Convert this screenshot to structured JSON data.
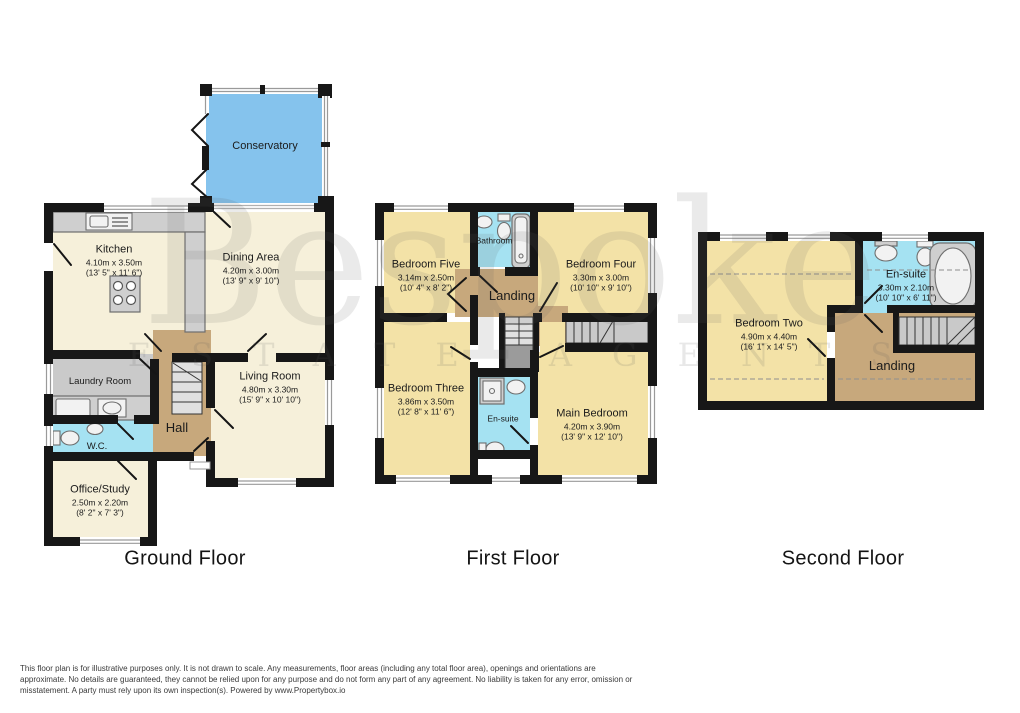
{
  "colors": {
    "wall": "#171717",
    "cream": "#f6f0da",
    "yellow": "#f3e2a7",
    "conservatory_blue": "#85c3ed",
    "bath_blue": "#a5e2f2",
    "hall_tan": "#c7a87c",
    "laundry_gray": "#cacaca"
  },
  "watermark": {
    "name": "Bespoke",
    "tagline": "ESTATE AGENTS"
  },
  "floors": {
    "ground": {
      "title": "Ground Floor",
      "rooms": {
        "conservatory": {
          "name": "Conservatory"
        },
        "kitchen": {
          "name": "Kitchen",
          "metric": "4.10m x 3.50m",
          "imperial": "(13' 5\" x 11' 6\")"
        },
        "dining": {
          "name": "Dining Area",
          "metric": "4.20m x 3.00m",
          "imperial": "(13' 9\" x 9' 10\")"
        },
        "laundry": {
          "name": "Laundry Room"
        },
        "hall": {
          "name": "Hall"
        },
        "wc": {
          "name": "W.C."
        },
        "living": {
          "name": "Living Room",
          "metric": "4.80m x 3.30m",
          "imperial": "(15' 9\" x 10' 10\")"
        },
        "office": {
          "name": "Office/Study",
          "metric": "2.50m x 2.20m",
          "imperial": "(8' 2\" x 7' 3\")"
        }
      }
    },
    "first": {
      "title": "First Floor",
      "rooms": {
        "bedroom5": {
          "name": "Bedroom Five",
          "metric": "3.14m x 2.50m",
          "imperial": "(10' 4\" x 8' 2\")"
        },
        "bathroom": {
          "name": "Bathroom"
        },
        "bedroom4": {
          "name": "Bedroom Four",
          "metric": "3.30m x 3.00m",
          "imperial": "(10' 10\" x 9' 10\")"
        },
        "landing": {
          "name": "Landing"
        },
        "bedroom3": {
          "name": "Bedroom Three",
          "metric": "3.86m x 3.50m",
          "imperial": "(12' 8\" x 11' 6\")"
        },
        "ensuite": {
          "name": "En-suite"
        },
        "main": {
          "name": "Main Bedroom",
          "metric": "4.20m x 3.90m",
          "imperial": "(13' 9\" x 12' 10\")"
        }
      }
    },
    "second": {
      "title": "Second Floor",
      "rooms": {
        "bedroom2": {
          "name": "Bedroom Two",
          "metric": "4.90m x 4.40m",
          "imperial": "(16' 1\" x 14' 5\")"
        },
        "ensuite": {
          "name": "En-suite",
          "metric": "3.30m x 2.10m",
          "imperial": "(10' 10\" x 6' 11\")"
        },
        "landing": {
          "name": "Landing"
        }
      }
    }
  },
  "footer": {
    "line1": "This floor plan is for illustrative purposes only. It is not drawn to scale. Any measurements, floor areas (including any total floor area), openings and orientations are",
    "line2": "approximate. No details are guaranteed, they cannot be relied upon for any purpose and do not form any part of any agreement. No liability is taken for any error, omission or",
    "line3": "misstatement. A party must rely upon its own inspection(s). Powered by www.Propertybox.io"
  }
}
